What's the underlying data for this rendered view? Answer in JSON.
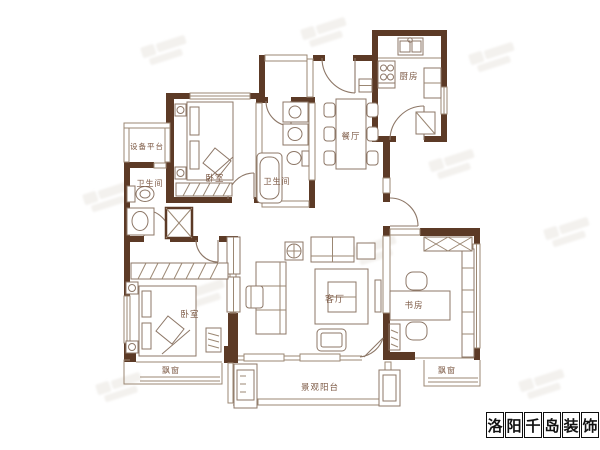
{
  "floorplan": {
    "labels": {
      "equipment_platform": "设备平台",
      "bath_left": "卫生间",
      "bedroom_top": "卧室",
      "bath_mid": "卫生间",
      "kitchen": "厨房",
      "dining": "餐厅",
      "living": "客厅",
      "bedroom_bottom": "卧室",
      "study": "书房",
      "bay_window_left": "飘窗",
      "bay_window_right": "飘窗",
      "balcony": "景观阳台"
    },
    "colors": {
      "wall": "#5c3a26",
      "furniture_line": "#8d7767",
      "label_text": "#7d5a45"
    }
  },
  "brand": {
    "name": "洛阳千岛装饰",
    "chars": [
      "洛",
      "阳",
      "千",
      "岛",
      "装",
      "饰"
    ]
  }
}
